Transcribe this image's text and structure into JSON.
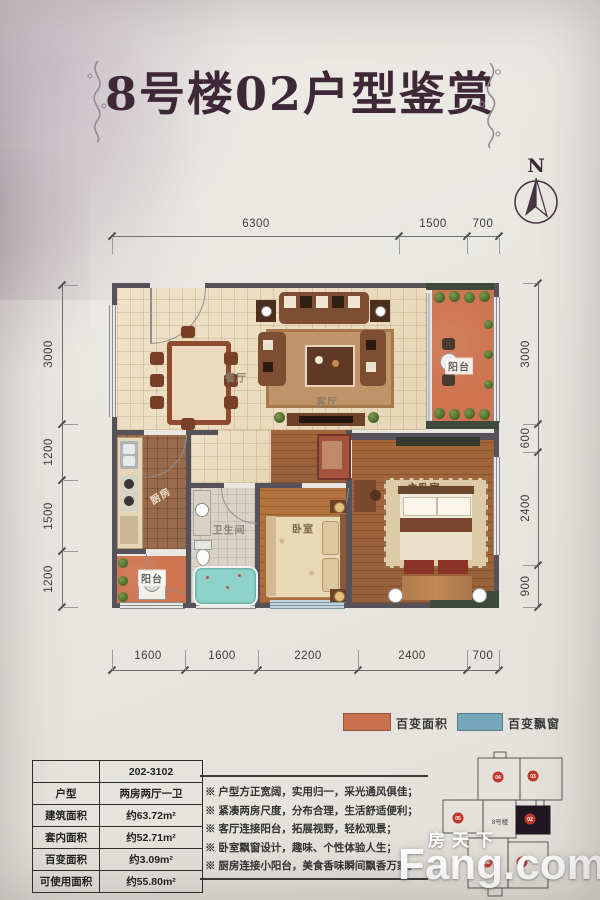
{
  "title": "8号楼02户型鉴赏",
  "compass": {
    "label": "N"
  },
  "dimensions": {
    "top": [
      "6300",
      "1500",
      "700"
    ],
    "bottom": [
      "1600",
      "1600",
      "2200",
      "2400",
      "700"
    ],
    "left": [
      "3000",
      "1200",
      "1500",
      "1200"
    ],
    "right": [
      "3000",
      "600",
      "2400",
      "900"
    ]
  },
  "rooms": {
    "dining": "餐厅",
    "living": "客厅",
    "living_balcony": "阳台",
    "kitchen": "厨房",
    "kitchen_balcony": "阳台",
    "bathroom": "卫生间",
    "bedroom": "卧室",
    "master_bedroom": "主卧室"
  },
  "legend": [
    {
      "label": "百变面积",
      "color": "#c8704f"
    },
    {
      "label": "百变飘窗",
      "color": "#74a6ba"
    }
  ],
  "info_table": {
    "rows": [
      {
        "label": "",
        "value": "202-3102"
      },
      {
        "label": "户型",
        "value": "两房两厅一卫"
      },
      {
        "label": "建筑面积",
        "value": "约63.72m²"
      },
      {
        "label": "套内面积",
        "value": "约52.71m²"
      },
      {
        "label": "百变面积",
        "value": "约3.09m²"
      },
      {
        "label": "可使用面积",
        "value": "约55.80m²"
      }
    ]
  },
  "features": [
    "※ 户型方正宽阔，实用归一，采光通风俱佳；",
    "※ 紧凑两房尺度，分布合理，生活舒适便利；",
    "※ 客厅连接阳台，拓展视野，轻松观景；",
    "※ 卧室飘窗设计，趣味、个性体验人生；",
    "※ 厨房连接小阳台，美食香味瞬间飘香万家。"
  ],
  "keyplan": {
    "building_label": "8号楼",
    "units": [
      "04",
      "03",
      "05",
      "02",
      "06",
      "01"
    ],
    "highlighted_unit": "02"
  },
  "watermark": {
    "cn": "房天下",
    "en": "Fang.com"
  }
}
